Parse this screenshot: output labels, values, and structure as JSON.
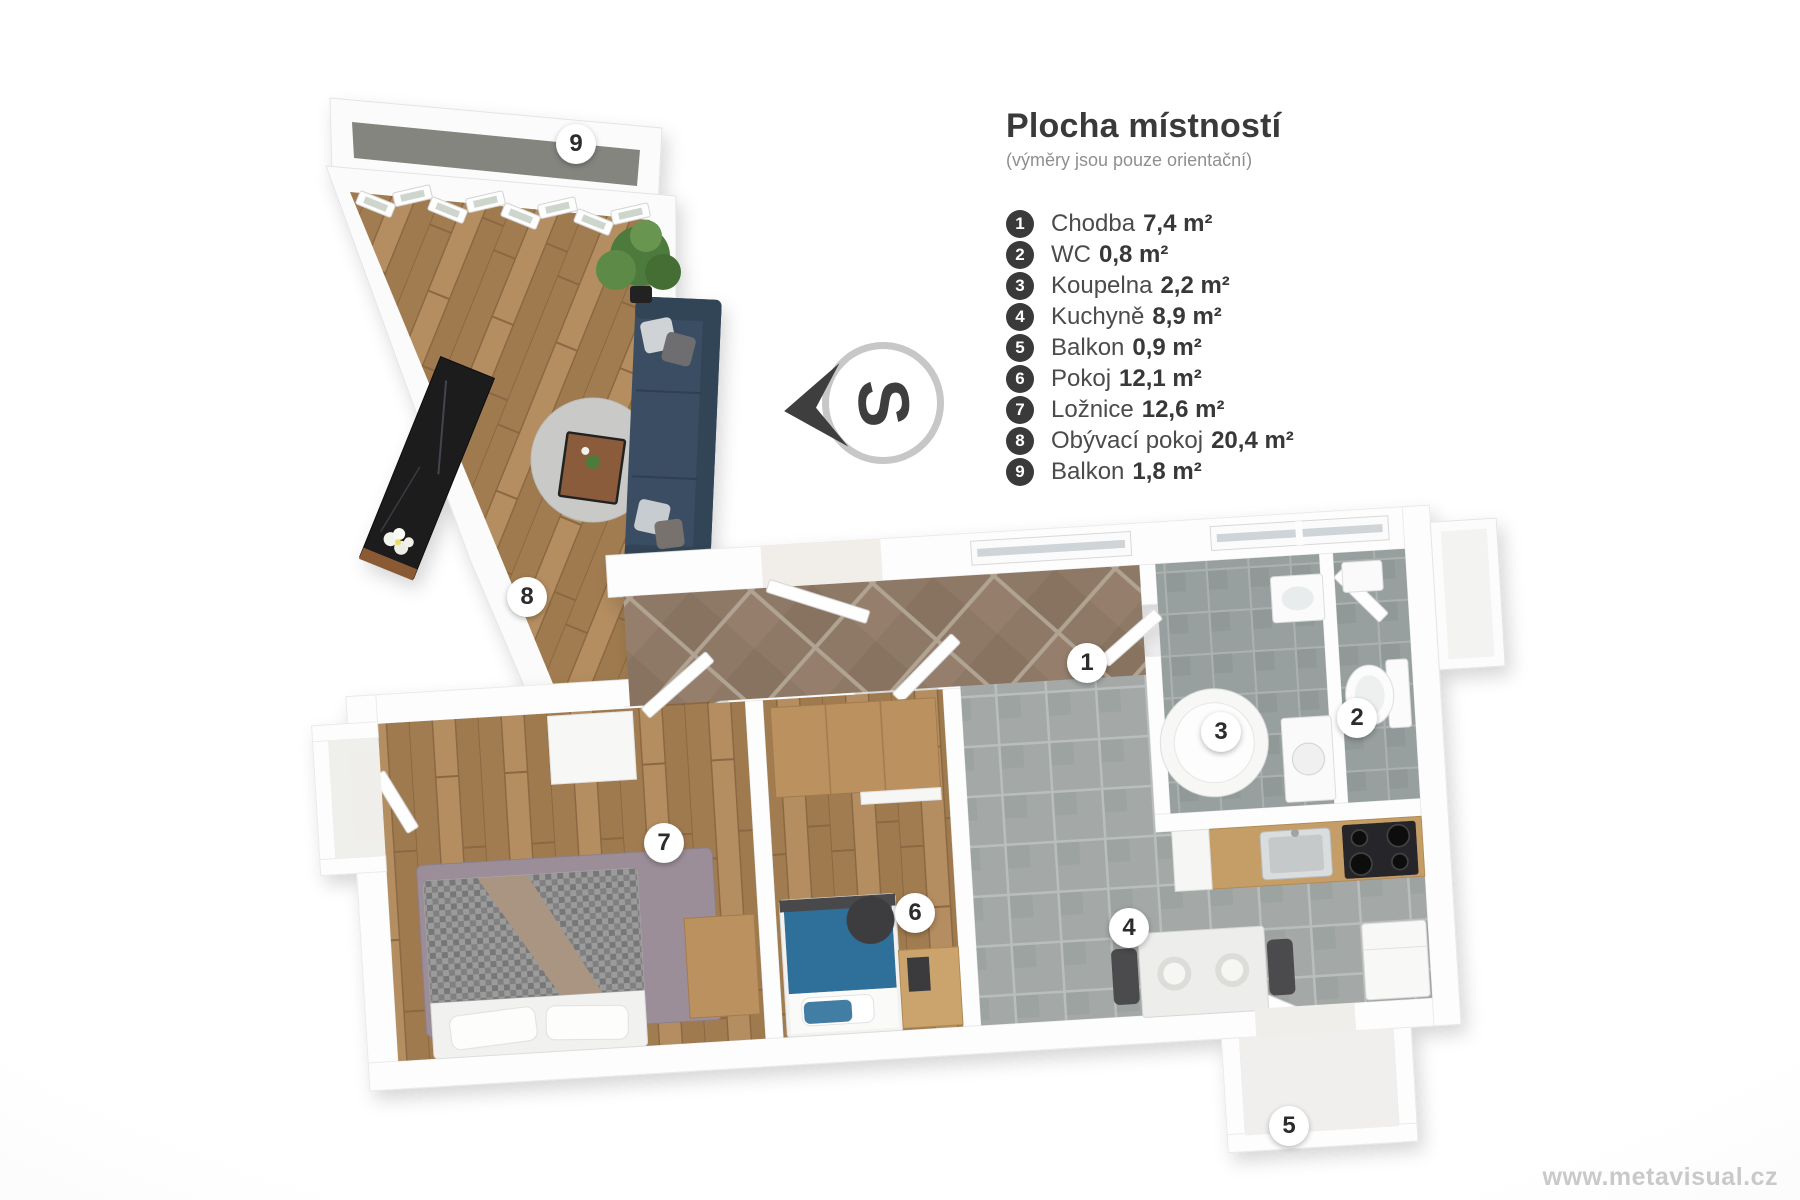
{
  "page": {
    "watermark": "www.metavisual.cz"
  },
  "legend": {
    "title": "Plocha místností",
    "subtitle": "(výměry jsou pouze orientační)",
    "items": [
      {
        "number": "1",
        "name": "Chodba",
        "area": "7,4 m²"
      },
      {
        "number": "2",
        "name": "WC",
        "area": "0,8 m²"
      },
      {
        "number": "3",
        "name": "Koupelna",
        "area": "2,2 m²"
      },
      {
        "number": "4",
        "name": "Kuchyně",
        "area": "8,9 m²"
      },
      {
        "number": "5",
        "name": "Balkon",
        "area": "0,9 m²"
      },
      {
        "number": "6",
        "name": "Pokoj",
        "area": "12,1 m²"
      },
      {
        "number": "7",
        "name": "Ložnice",
        "area": "12,6 m²"
      },
      {
        "number": "8",
        "name": "Obývací pokoj",
        "area": "20,4 m²"
      },
      {
        "number": "9",
        "name": "Balkon",
        "area": "1,8 m²"
      }
    ]
  },
  "compass": {
    "letter": "S"
  },
  "plan": {
    "badges": [
      {
        "number": "1",
        "x": 1087,
        "y": 663
      },
      {
        "number": "2",
        "x": 1357,
        "y": 718
      },
      {
        "number": "3",
        "x": 1221,
        "y": 732
      },
      {
        "number": "4",
        "x": 1129,
        "y": 928
      },
      {
        "number": "5",
        "x": 1289,
        "y": 1126
      },
      {
        "number": "6",
        "x": 915,
        "y": 913
      },
      {
        "number": "7",
        "x": 664,
        "y": 843
      },
      {
        "number": "8",
        "x": 527,
        "y": 597
      },
      {
        "number": "9",
        "x": 576,
        "y": 144
      }
    ],
    "colors": {
      "wood_floor": "#ab855b",
      "hall_tile": "#8e7866",
      "gray_tile": "#a4a9a7",
      "bath_tile": "#98a09f",
      "living_rug": "#c9c9c7",
      "bedroom_rug": "#9c8e98",
      "sofa": "#3b4d62",
      "bed_blue": "#2e6f99",
      "marble_sideboard": "#1b1b1e",
      "kitchen_counter": "#c59d66"
    }
  }
}
